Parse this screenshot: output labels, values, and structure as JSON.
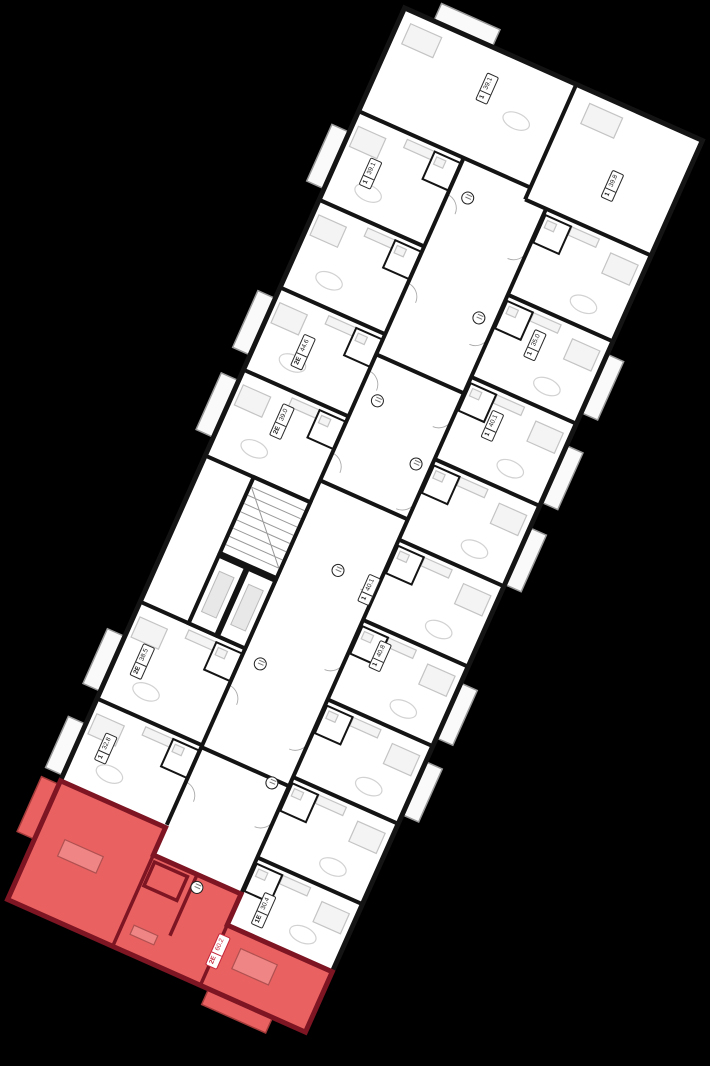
{
  "scene": {
    "background_color": "#000000"
  },
  "plan": {
    "rotation_deg": 24,
    "colors": {
      "floor": "#ffffff",
      "walls": "#141414",
      "furniture": "#c4c4c4",
      "balcony_outline": "#9a9a9a",
      "highlight_fill": "#e96161",
      "highlight_wall": "#7d1522",
      "highlight_text": "#c4273a"
    },
    "units": [
      {
        "rooms": "1",
        "area": "39.1",
        "x": 110,
        "y": 42,
        "zone": "top",
        "selected": false
      },
      {
        "rooms": "1",
        "area": "39.8",
        "x": 264,
        "y": 80,
        "zone": "right",
        "selected": false
      },
      {
        "rooms": "1",
        "area": "39.1",
        "x": 38,
        "y": 167,
        "zone": "left",
        "selected": false
      },
      {
        "rooms": "1",
        "area": "35.0",
        "x": 258,
        "y": 257,
        "zone": "right",
        "selected": false
      },
      {
        "rooms": "2Е",
        "area": "44.6",
        "x": 49,
        "y": 358,
        "zone": "left",
        "selected": false
      },
      {
        "rooms": "1",
        "area": "40.1",
        "x": 252,
        "y": 348,
        "zone": "right",
        "selected": false
      },
      {
        "rooms": "2Е",
        "area": "39.0",
        "x": 58,
        "y": 430,
        "zone": "left",
        "selected": false
      },
      {
        "rooms": "1",
        "area": "40.1",
        "x": 206,
        "y": 548,
        "zone": "right",
        "selected": false
      },
      {
        "rooms": "1",
        "area": "40.8",
        "x": 243,
        "y": 604,
        "zone": "right",
        "selected": false
      },
      {
        "rooms": "2Е",
        "area": "38.5",
        "x": 28,
        "y": 706,
        "zone": "left",
        "selected": false
      },
      {
        "rooms": "1",
        "area": "32.8",
        "x": 30,
        "y": 800,
        "zone": "left",
        "selected": false
      },
      {
        "rooms": "1Е",
        "area": "30.4",
        "x": 240,
        "y": 884,
        "zone": "right",
        "selected": false
      },
      {
        "rooms": "2Е",
        "area": "60.2",
        "x": 215,
        "y": 940,
        "zone": "red",
        "selected": true
      }
    ],
    "markers": [
      {
        "x": 137,
        "y": 150,
        "zone": "corridor"
      },
      {
        "x": 196,
        "y": 255,
        "zone": "corridor"
      },
      {
        "x": 137,
        "y": 372,
        "zone": "corridor"
      },
      {
        "x": 198,
        "y": 414,
        "zone": "corridor"
      },
      {
        "x": 170,
        "y": 543,
        "zone": "corridor"
      },
      {
        "x": 137,
        "y": 660,
        "zone": "corridor"
      },
      {
        "x": 196,
        "y": 764,
        "zone": "corridor"
      },
      {
        "x": 170,
        "y": 890,
        "zone": "red"
      }
    ]
  }
}
